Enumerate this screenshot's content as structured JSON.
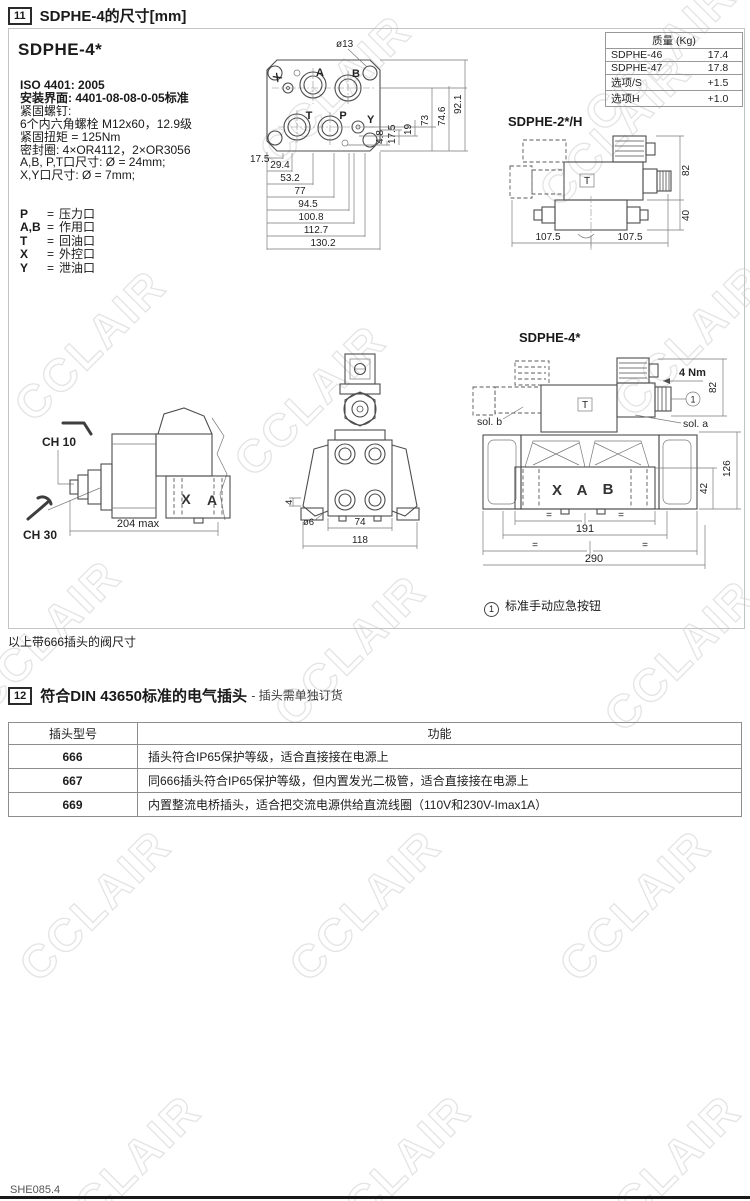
{
  "watermark": "CCLAIR",
  "header": {
    "num": "11",
    "title": "SDPHE-4的尺寸[mm]"
  },
  "model_title": "SDPHE-4*",
  "specs": {
    "iso": "ISO 4401: 2005",
    "mount": "安装界面: 4401-08-08-0-05标准",
    "lines": [
      "紧固螺钉:",
      "6个内六角螺栓 M12x60，12.9级",
      "紧固扭矩 = 125Nm",
      "密封圈: 4×OR4112，2×OR3056",
      "A,B, P,T口尺寸: Ø = 24mm;",
      "X,Y口尺寸: Ø = 7mm;"
    ]
  },
  "legend_eq": "=",
  "legend": [
    {
      "k": "P",
      "d": "压力口"
    },
    {
      "k": "A,B",
      "d": "作用口"
    },
    {
      "k": "T",
      "d": "回油口"
    },
    {
      "k": "X",
      "d": "外控口"
    },
    {
      "k": "Y",
      "d": "泄油口"
    }
  ],
  "weight_table": {
    "header": "质量 (Kg)",
    "rows": [
      [
        "SDPHE-46",
        "17.4"
      ],
      [
        "SDPHE-47",
        "17.8"
      ],
      [
        "选项/S",
        "+1.5"
      ],
      [
        "选项H",
        "+1.0"
      ]
    ]
  },
  "face": {
    "dia": "ø13",
    "px": "X",
    "pa": "A",
    "pb": "B",
    "pt": "T",
    "pp": "P",
    "py": "Y",
    "h": [
      "17.5",
      "29.4",
      "53.2",
      "77",
      "94.5",
      "100.8",
      "112.7",
      "130.2"
    ],
    "v": [
      "4.8",
      "17.5",
      "19",
      "73",
      "74.6",
      "92.1"
    ]
  },
  "sdphe2": {
    "label": "SDPHE-2*/H",
    "t": "T",
    "d82": "82",
    "d40": "40",
    "w1": "107.5",
    "w2": "107.5"
  },
  "side": {
    "ch10": "CH 10",
    "ch30": "CH 30",
    "len": "204 max",
    "x": "X",
    "a": "A"
  },
  "front": {
    "d4": "4",
    "d6": "ø6",
    "d74": "74",
    "d118": "118"
  },
  "sdphe4": {
    "label": "SDPHE-4*",
    "solb": "sol. b",
    "sola": "sol. a",
    "nm": "4 Nm",
    "one": "1",
    "t": "T",
    "x": "X",
    "a": "A",
    "b": "B",
    "d82": "82",
    "d126": "126",
    "d42": "42",
    "d191": "191",
    "d290": "290",
    "eq": "="
  },
  "override_note": {
    "num": "1",
    "text": "标准手动应急按钮"
  },
  "note666": "以上带666插头的阀尺寸",
  "section12": {
    "num": "12",
    "title": "符合DIN 43650标准的电气插头",
    "suffix": "- 插头需单独订货"
  },
  "plug_table": {
    "headers": [
      "插头型号",
      "功能"
    ],
    "rows": [
      [
        "666",
        "插头符合IP65保护等级，适合直接接在电源上"
      ],
      [
        "667",
        "同666插头符合IP65保护等级，但内置发光二极管，适合直接接在电源上"
      ],
      [
        "669",
        "内置整流电桥插头，适合把交流电源供给直流线圈（110V和230V-Imax1A）"
      ]
    ]
  },
  "footer": "SHE085.4"
}
